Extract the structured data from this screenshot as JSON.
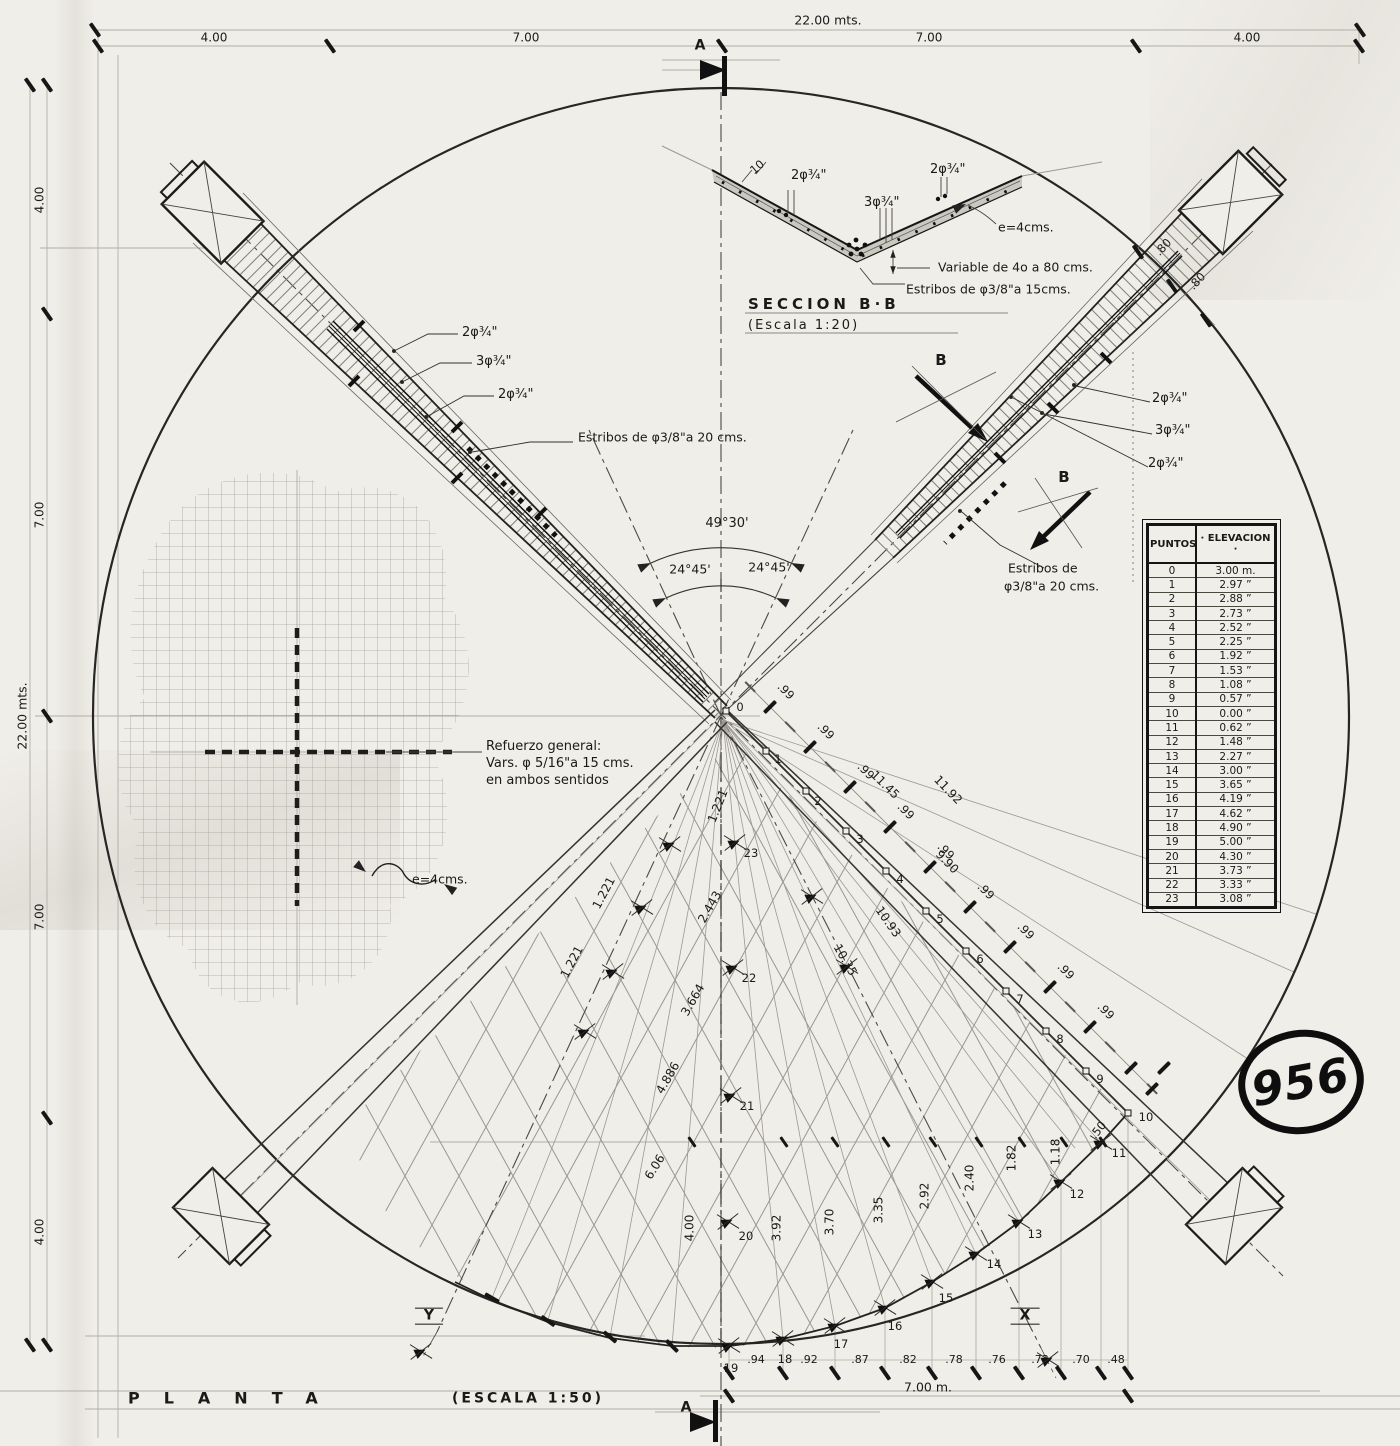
{
  "drawing_number": "956",
  "plan": {
    "title": "PLANTA",
    "scale": "(ESCALA  1:50)"
  },
  "section": {
    "title": "SECCION  B·B",
    "scale": "(Escala  1:20)",
    "dim_10": "10",
    "bars_top_left": "2φ¾\"",
    "bars_bottom": "3φ¾\"",
    "bars_top_right": "2φ¾\"",
    "shell_thickness": "e=4cms.",
    "depth_note": "Variable de 4o a 80 cms.",
    "stirrups": "Estribos de φ3/8\"a 15cms."
  },
  "dims": {
    "top_total": "22.00 mts.",
    "top_segments": [
      "4.00",
      "7.00",
      "7.00",
      "4.00"
    ],
    "left_total": "22.00 mts.",
    "left_segments": [
      "4.00",
      "7.00",
      "7.00",
      "4.00"
    ],
    "bottom_segments": [
      ".94",
      ".92",
      ".87",
      ".82",
      ".78",
      ".76",
      ".73",
      ".70",
      ".48"
    ],
    "bottom_total": "7.00 m."
  },
  "left_beam": {
    "bars_top": "2φ¾\"",
    "bars_mid": "3φ¾\"",
    "bars_bottom": "2φ¾\"",
    "stirrups": "Estribos de φ3/8\"a 20 cms."
  },
  "right_beam": {
    "bars_top": "2φ¾\"",
    "bars_mid": "3φ¾\"",
    "bars_bottom": "2φ¾\"",
    "stirrups_line1": "Estribos de",
    "stirrups_line2": "φ3/8\"a 20 cms.",
    "end_spacing": [
      ".80",
      ".80"
    ]
  },
  "mesh": {
    "line1": "Refuerzo general:",
    "line2": "Vars. φ 5/16\"a 15 cms.",
    "line3": "en ambos sentidos",
    "thickness": "e=4cms."
  },
  "angles": {
    "total": "49°30'",
    "left": "24°45'",
    "right": "24°45'"
  },
  "markers": {
    "section_a": "A",
    "section_b": "B",
    "x": "X",
    "y": "Y"
  },
  "chain": {
    "spacing": ".99",
    "half": ".50"
  },
  "offsets": [
    "4.00",
    "3.92",
    "3.70",
    "3.35",
    "2.92",
    "2.40",
    "1.82",
    "1.18"
  ],
  "fan_labels": [
    "1.221",
    "1.221",
    "1.221",
    "2.443",
    "3.664",
    "4.886",
    "6.06",
    "11.45",
    "11.92",
    "9.90",
    "10.93",
    "10.35"
  ],
  "table": {
    "col_points": "PUNTOS",
    "col_elev": "· ELEVACION ·"
  },
  "points": [
    {
      "n": "0",
      "elev": "3.00 m."
    },
    {
      "n": "1",
      "elev": "2.97 ”"
    },
    {
      "n": "2",
      "elev": "2.88 ”"
    },
    {
      "n": "3",
      "elev": "2.73 ”"
    },
    {
      "n": "4",
      "elev": "2.52 ”"
    },
    {
      "n": "5",
      "elev": "2.25 ”"
    },
    {
      "n": "6",
      "elev": "1.92 ”"
    },
    {
      "n": "7",
      "elev": "1.53 ”"
    },
    {
      "n": "8",
      "elev": "1.08 ”"
    },
    {
      "n": "9",
      "elev": "0.57 ”"
    },
    {
      "n": "10",
      "elev": "0.00 ”"
    },
    {
      "n": "11",
      "elev": "0.62 ”"
    },
    {
      "n": "12",
      "elev": "1.48 ”"
    },
    {
      "n": "13",
      "elev": "2.27 ”"
    },
    {
      "n": "14",
      "elev": "3.00 ”"
    },
    {
      "n": "15",
      "elev": "3.65 ”"
    },
    {
      "n": "16",
      "elev": "4.19 ”"
    },
    {
      "n": "17",
      "elev": "4.62 ”"
    },
    {
      "n": "18",
      "elev": "4.90 ”"
    },
    {
      "n": "19",
      "elev": "5.00 ”"
    },
    {
      "n": "20",
      "elev": "4.30 ”"
    },
    {
      "n": "21",
      "elev": "3.73 ”"
    },
    {
      "n": "22",
      "elev": "3.33 ”"
    },
    {
      "n": "23",
      "elev": "3.08 ”"
    }
  ]
}
